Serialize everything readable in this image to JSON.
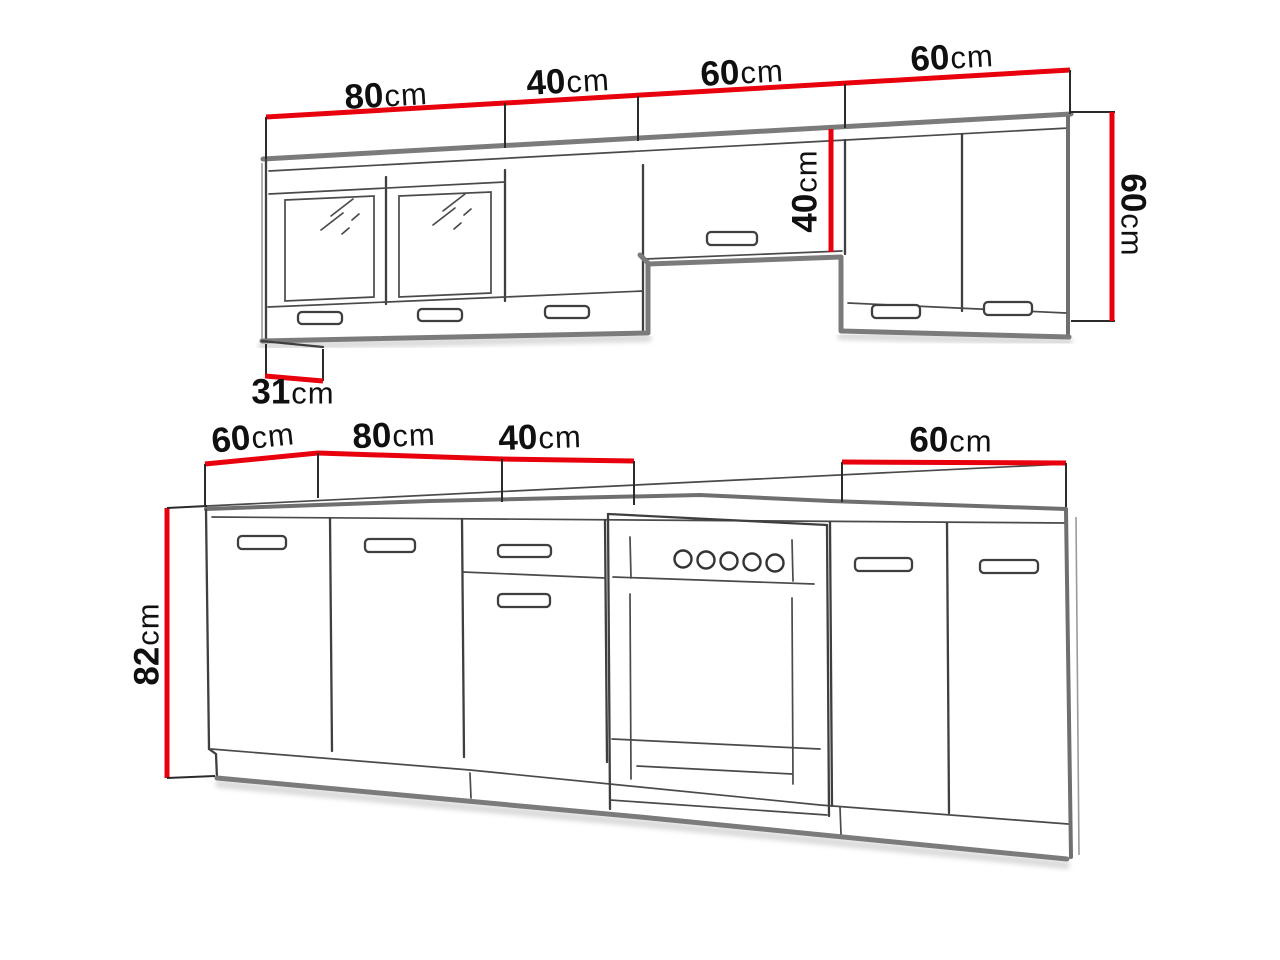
{
  "diagram": {
    "background": "#ffffff",
    "accent_red": "#e8000d",
    "line_dark": "#3f3f3f",
    "line_gray": "#7b7b7b",
    "text_color": "#101010",
    "wall_row": {
      "widths": [
        {
          "value": "80",
          "unit": "cm"
        },
        {
          "value": "40",
          "unit": "cm"
        },
        {
          "value": "60",
          "unit": "cm"
        },
        {
          "value": "60",
          "unit": "cm"
        }
      ],
      "hood_unit_height": {
        "value": "40",
        "unit": "cm"
      },
      "side_height": {
        "value": "60",
        "unit": "cm"
      },
      "depth": {
        "value": "31",
        "unit": "cm"
      }
    },
    "base_row": {
      "widths_left": [
        {
          "value": "60",
          "unit": "cm"
        },
        {
          "value": "80",
          "unit": "cm"
        },
        {
          "value": "40",
          "unit": "cm"
        }
      ],
      "width_right": {
        "value": "60",
        "unit": "cm"
      },
      "side_height": {
        "value": "82",
        "unit": "cm"
      }
    }
  }
}
